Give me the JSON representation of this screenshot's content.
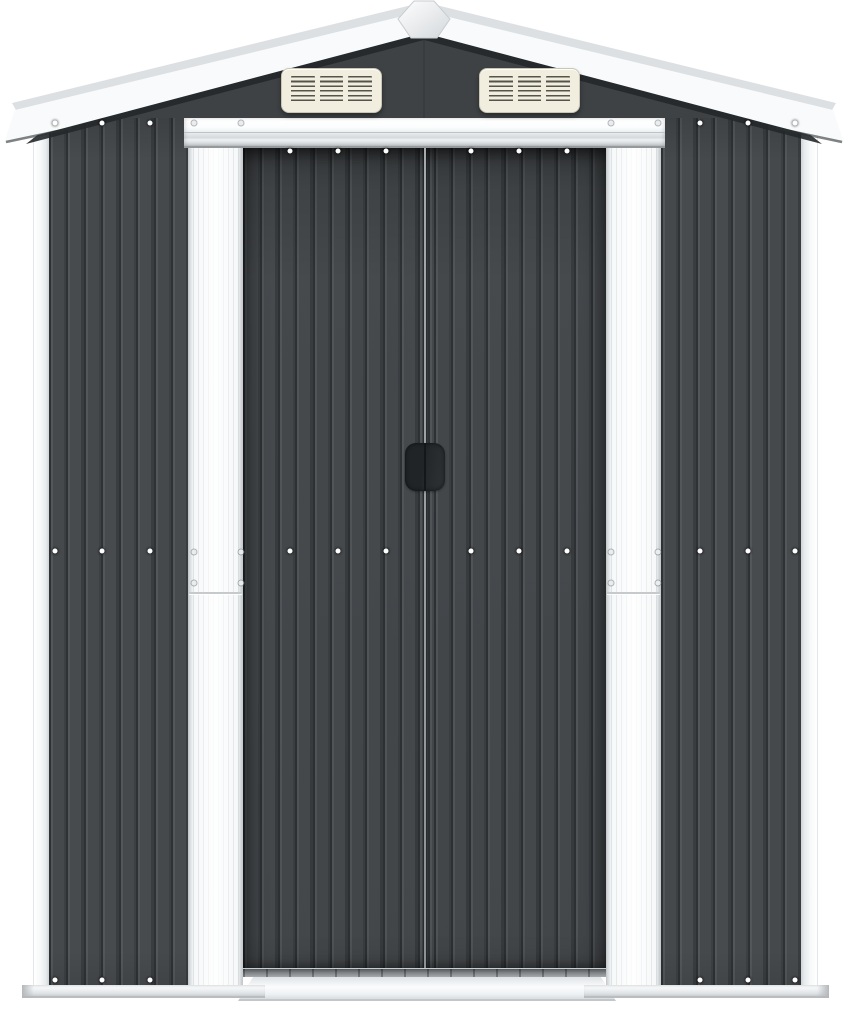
{
  "meta": {
    "type": "product-photo",
    "description": "Front view of an anthracite grey galvanised steel garden shed with white trim: gable roof with diamond apex cap, two louvred gable vents and central sliding double doors, photographed on a plain white background"
  },
  "components": {
    "roof": {
      "label": "White gable roof fascia",
      "finial_label": "Diamond roof apex cap"
    },
    "gable": {
      "label": "Anthracite gable panel"
    },
    "vents": {
      "count": 2,
      "label": "Louvred air vent",
      "columns_per_vent": 3,
      "slats_per_column": 6
    },
    "doors": {
      "count": 2,
      "label": "Sliding double doors",
      "handle_label": "Recessed central door handle"
    },
    "walls": {
      "label": "Corrugated anthracite wall panel"
    },
    "trims": {
      "corner_label": "White corner trim",
      "door_side_label": "White door-side trim strip",
      "header_label": "White door header track"
    },
    "base": {
      "rail_label": "White base rail",
      "threshold_label": "Door threshold ramp"
    },
    "fasteners": {
      "label": "Screw fastener",
      "wall_rows": 3,
      "door_rows": 2
    }
  },
  "colors": {
    "background": "#ffffff",
    "wall_face": "#45494c",
    "wall_groove": "#2e3235",
    "wall_highlight": "#53575a",
    "gable": "#3e4245",
    "trim_white": "#f6f8f9",
    "trim_ridge": "#dfe3e5",
    "trim_edge": "#c6cacd",
    "header_shadow": "#96999c",
    "vent_cream": "#f1eee0",
    "vent_slat": "#55544a",
    "vent_border": "#c9c6b4",
    "handle_dark": "#25282a",
    "track_gray": "#7d8184",
    "roof_white": "#f8fafb",
    "roof_gray": "#dde0e2",
    "roof_shadow": "#24282a",
    "base_light": "#eef1f3",
    "screw_white": "#ffffff"
  }
}
